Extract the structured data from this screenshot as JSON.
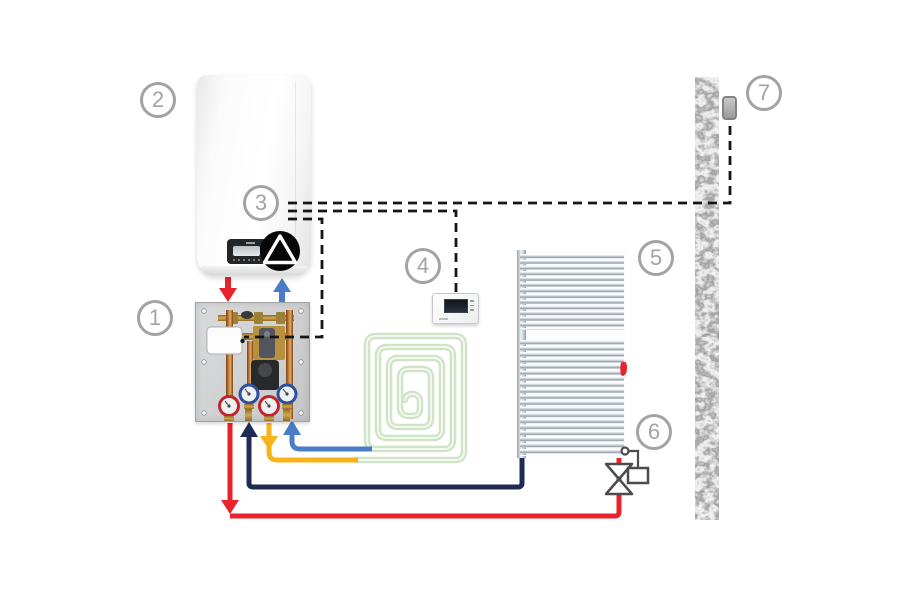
{
  "diagram_title": "hydronic heating system connection diagram",
  "labels": [
    {
      "number": "1",
      "refers_to": "pump-mixing-manifold-unit"
    },
    {
      "number": "2",
      "refers_to": "wall-hung-boiler"
    },
    {
      "number": "3",
      "refers_to": "boiler-control-wiring"
    },
    {
      "number": "4",
      "refers_to": "room-thermostat"
    },
    {
      "number": "5",
      "refers_to": "towel-radiator"
    },
    {
      "number": "6",
      "refers_to": "zone-valve"
    },
    {
      "number": "7",
      "refers_to": "outdoor-sensor-on-wall"
    }
  ],
  "colors": {
    "pipe-red": "#e8232b",
    "pipe-blue": "#4a7cc7",
    "pipe-navy": "#1e2b52",
    "pipe-yellow": "#f8b21a",
    "coil-green": "#cfe4c7",
    "coil-core": "#f2f7ef",
    "wire-black": "#161616",
    "label-gray": "#a3a3a3",
    "valve-gray": "#4c4c4c"
  }
}
